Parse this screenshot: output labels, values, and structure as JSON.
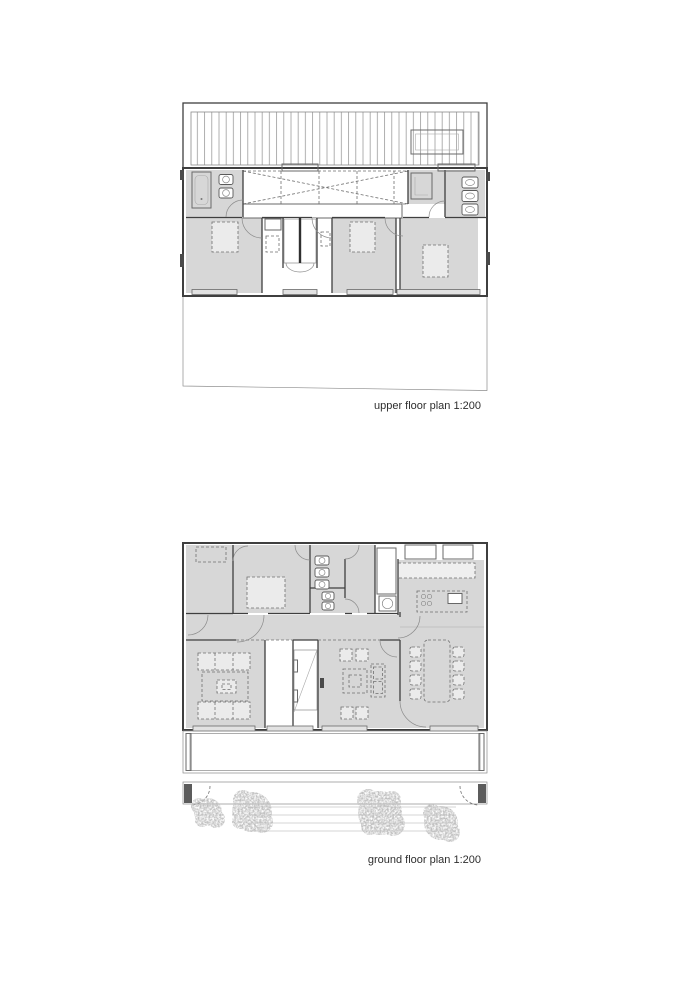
{
  "captions": {
    "upper": "upper floor plan 1:200",
    "ground": "ground floor plan 1:200"
  },
  "colors": {
    "room_fill": "#d7d7d7",
    "roof_fill": "#ececec",
    "wall": "#3f3f3f",
    "line": "#8b8b8b",
    "dash": "#6f6f6f",
    "tree": "#8f8f8f",
    "background": "#ffffff"
  }
}
